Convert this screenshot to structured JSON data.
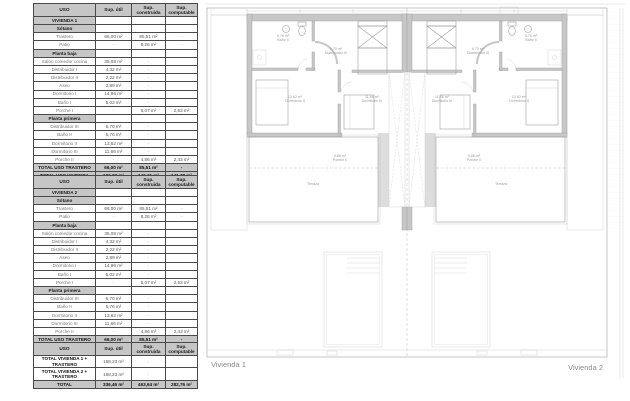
{
  "colors": {
    "table_header_bg": "#c6c6c6",
    "wall_gray": "#c7c7c7",
    "line_gray": "#9e9e9e",
    "label_gray": "#9a9a9a"
  },
  "tables": {
    "vivienda1": {
      "columns": [
        "USO",
        "Sup. útil",
        "Sup. construida",
        "Sup. computable"
      ],
      "rows": [
        {
          "style": "section",
          "cells": [
            "VIVIENDA 1",
            "",
            "",
            ""
          ]
        },
        {
          "style": "section",
          "cells": [
            "Sótano",
            "",
            "",
            ""
          ]
        },
        {
          "style": "data",
          "cells": [
            "Trastero",
            "66,00 m²",
            "85,51 m²",
            "-"
          ]
        },
        {
          "style": "data",
          "cells": [
            "Patio",
            "-",
            "8,26 m²",
            "-"
          ]
        },
        {
          "style": "section",
          "cells": [
            "Planta baja",
            "",
            "",
            ""
          ]
        },
        {
          "style": "data",
          "cells": [
            "Salón comedor cocina",
            "35,08 m²",
            "-",
            ""
          ]
        },
        {
          "style": "data",
          "cells": [
            "Distribuidor I",
            "4,32 m²",
            "-",
            ""
          ]
        },
        {
          "style": "data",
          "cells": [
            "Distribuidor II",
            "2,22 m²",
            "-",
            ""
          ]
        },
        {
          "style": "data",
          "cells": [
            "Aseo",
            "2,89 m²",
            "-",
            ""
          ]
        },
        {
          "style": "data",
          "cells": [
            "Dormitorio I",
            "14,96 m²",
            "-",
            ""
          ]
        },
        {
          "style": "data",
          "cells": [
            "Baño I",
            "5,02 m²",
            "-",
            ""
          ]
        },
        {
          "style": "data",
          "cells": [
            "Porche I",
            "-",
            "5,07 m²",
            "2,53 m²"
          ]
        },
        {
          "style": "section",
          "cells": [
            "Planta primera",
            "",
            "",
            ""
          ]
        },
        {
          "style": "data",
          "cells": [
            "Distribuidor III",
            "6,70 m²",
            "-",
            ""
          ]
        },
        {
          "style": "data",
          "cells": [
            "Baño II",
            "5,76 m²",
            "-",
            ""
          ]
        },
        {
          "style": "data",
          "cells": [
            "Dormitorio II",
            "13,62 m²",
            "-",
            ""
          ]
        },
        {
          "style": "data",
          "cells": [
            "Dormitorio III",
            "11,66 m²",
            "-",
            ""
          ]
        },
        {
          "style": "data",
          "cells": [
            "Porche II",
            "-",
            "4,86 m²",
            "2,43 m²"
          ]
        },
        {
          "style": "total",
          "cells": [
            "TOTAL USO TRASTERO",
            "66,00 m²",
            "85,51 m²",
            "-"
          ]
        },
        {
          "style": "total",
          "cells": [
            "TOTAL USO VIVIENDA",
            "102,23 m²",
            "146,31 m²",
            "141,38 m²"
          ]
        }
      ]
    },
    "vivienda2": {
      "columns": [
        "USO",
        "Sup. útil",
        "Sup. construida",
        "Sup. computable"
      ],
      "rows": [
        {
          "style": "section",
          "cells": [
            "VIVIENDA 2",
            "",
            "",
            ""
          ]
        },
        {
          "style": "section",
          "cells": [
            "Sótano",
            "",
            "",
            ""
          ]
        },
        {
          "style": "data",
          "cells": [
            "Trastero",
            "66,00 m²",
            "85,51 m²",
            "-"
          ]
        },
        {
          "style": "data",
          "cells": [
            "Patio",
            "-",
            "8,26 m²",
            "-"
          ]
        },
        {
          "style": "section",
          "cells": [
            "Planta baja",
            "",
            "",
            ""
          ]
        },
        {
          "style": "data",
          "cells": [
            "Salón comedor cocina",
            "35,08 m²",
            "-",
            ""
          ]
        },
        {
          "style": "data",
          "cells": [
            "Distribuidor I",
            "4,32 m²",
            "-",
            ""
          ]
        },
        {
          "style": "data",
          "cells": [
            "Distribuidor II",
            "2,22 m²",
            "-",
            ""
          ]
        },
        {
          "style": "data",
          "cells": [
            "Aseo",
            "2,89 m²",
            "-",
            ""
          ]
        },
        {
          "style": "data",
          "cells": [
            "Dormitorio I",
            "14,96 m²",
            "-",
            ""
          ]
        },
        {
          "style": "data",
          "cells": [
            "Baño I",
            "5,02 m²",
            "-",
            ""
          ]
        },
        {
          "style": "data",
          "cells": [
            "Porche I",
            "-",
            "5,07 m²",
            "2,53 m²"
          ]
        },
        {
          "style": "section",
          "cells": [
            "Planta primera",
            "",
            "",
            ""
          ]
        },
        {
          "style": "data",
          "cells": [
            "Distribuidor III",
            "6,70 m²",
            "-",
            ""
          ]
        },
        {
          "style": "data",
          "cells": [
            "Baño II",
            "5,76 m²",
            "-",
            ""
          ]
        },
        {
          "style": "data",
          "cells": [
            "Dormitorio II",
            "13,62 m²",
            "-",
            ""
          ]
        },
        {
          "style": "data",
          "cells": [
            "Dormitorio III",
            "11,66 m²",
            "-",
            ""
          ]
        },
        {
          "style": "data",
          "cells": [
            "Porche II",
            "-",
            "4,86 m²",
            "2,43 m²"
          ]
        },
        {
          "style": "total",
          "cells": [
            "TOTAL USO TRASTERO",
            "66,00 m²",
            "85,51 m²",
            "-"
          ]
        },
        {
          "style": "total",
          "cells": [
            "TOTAL USO VIVIENDA",
            "102,23 m²",
            "146,31 m²",
            "141,38 m²"
          ]
        }
      ]
    },
    "totals": {
      "columns": [
        "USO",
        "Sup. útil",
        "Sup. construida",
        "Sup. computable"
      ],
      "rows": [
        {
          "style": "rowhead",
          "cells": [
            "TOTAL VIVIENDA 1 + TRASTERO",
            "168,23 m²",
            "-",
            ""
          ]
        },
        {
          "style": "rowhead",
          "cells": [
            "TOTAL VIVIENDA 2 + TRASTERO",
            "168,23 m²",
            "-",
            ""
          ]
        },
        {
          "style": "total",
          "cells": [
            "TOTAL",
            "336,46 m²",
            "463,64 m²",
            "282,76 m²"
          ]
        }
      ]
    }
  },
  "plan": {
    "vivienda1_label": "Vivienda 1",
    "vivienda2_label": "Vivienda 2",
    "room_labels": [
      {
        "x": 83,
        "y": 37,
        "lines": [
          "5,76 m²",
          "Baño II"
        ]
      },
      {
        "x": 136,
        "y": 50,
        "lines": [
          "6,70 m²",
          "Distribuidor III"
        ]
      },
      {
        "x": 95,
        "y": 98,
        "lines": [
          "13,62 m²",
          "Dormitorio II"
        ]
      },
      {
        "x": 172,
        "y": 98,
        "lines": [
          "11,66 m²",
          "Dormitorio III"
        ]
      },
      {
        "x": 140,
        "y": 157,
        "lines": [
          "4,86 m²",
          "Porche II"
        ]
      },
      {
        "x": 113,
        "y": 185,
        "lines": [
          "Terraza"
        ]
      },
      {
        "x": 331,
        "y": 37,
        "lines": [
          "5,76 m²",
          "Baño II"
        ]
      },
      {
        "x": 278,
        "y": 50,
        "lines": [
          "6,70 m²",
          "Distribuidor III"
        ]
      },
      {
        "x": 319,
        "y": 98,
        "lines": [
          "13,62 m²",
          "Dormitorio II"
        ]
      },
      {
        "x": 242,
        "y": 98,
        "lines": [
          "11,66 m²",
          "Dormitorio III"
        ]
      },
      {
        "x": 274,
        "y": 157,
        "lines": [
          "4,86 m²",
          "Porche II"
        ]
      },
      {
        "x": 301,
        "y": 185,
        "lines": [
          "Terraza"
        ]
      }
    ]
  }
}
